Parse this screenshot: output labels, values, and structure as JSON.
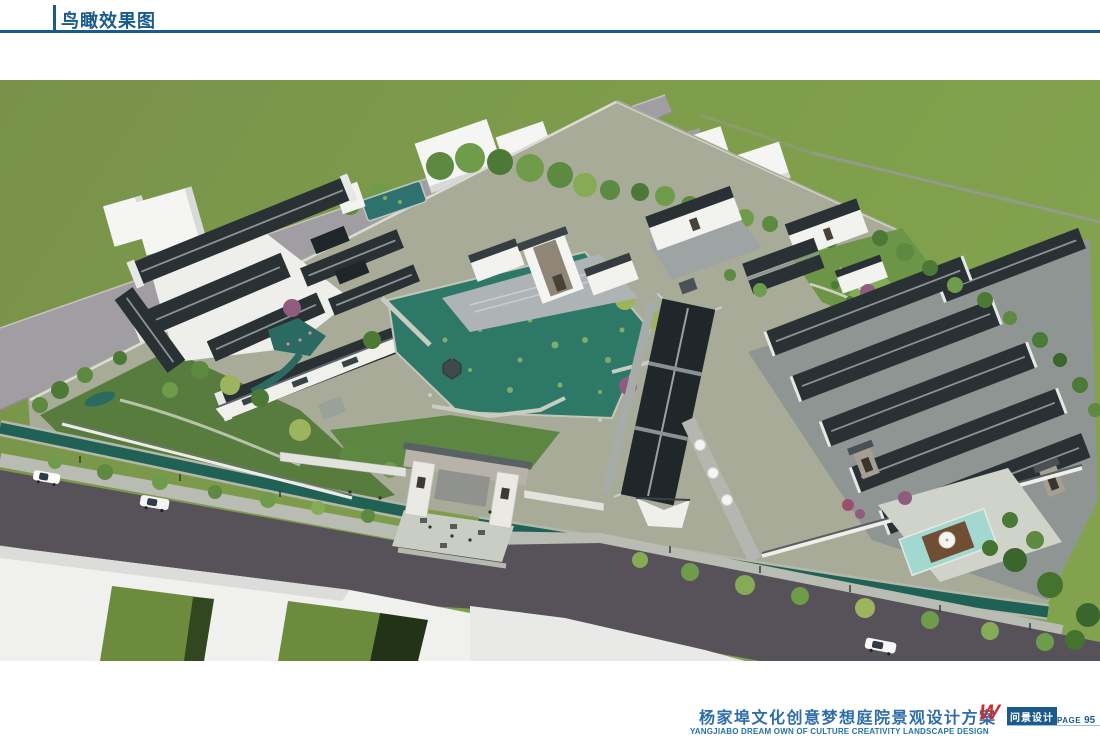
{
  "header": {
    "title": "鸟瞰效果图"
  },
  "footer": {
    "project_title_cn": "杨家埠文化创意梦想庭院景观设计方案",
    "project_title_en": "YANGJIABO DREAM OWN OF CULTURE CREATIVITY LANDSCAPE DESIGN",
    "logo_mark": "W",
    "logo_name": "问景设计",
    "page_label": "PAGE",
    "page_number": "95"
  },
  "colors": {
    "header-blue": "#1a5a8c",
    "title-blue": "#2e6da8",
    "logo-red": "#d42a2c",
    "badge-blue": "#1c5a8c",
    "field-green": "#7d9a4b",
    "road-dark": "#57525a",
    "road-back": "#a19ea3",
    "sidewalk": "#b9bcb2",
    "canal-teal": "#206156",
    "pond-teal": "#2e7868",
    "roof-dark": "#2a3134",
    "wall-white": "#f2f2ef",
    "block-white": "#f5f5f3",
    "tree-green": "#5d8a40",
    "pool-aqua": "#a3d8d0"
  }
}
